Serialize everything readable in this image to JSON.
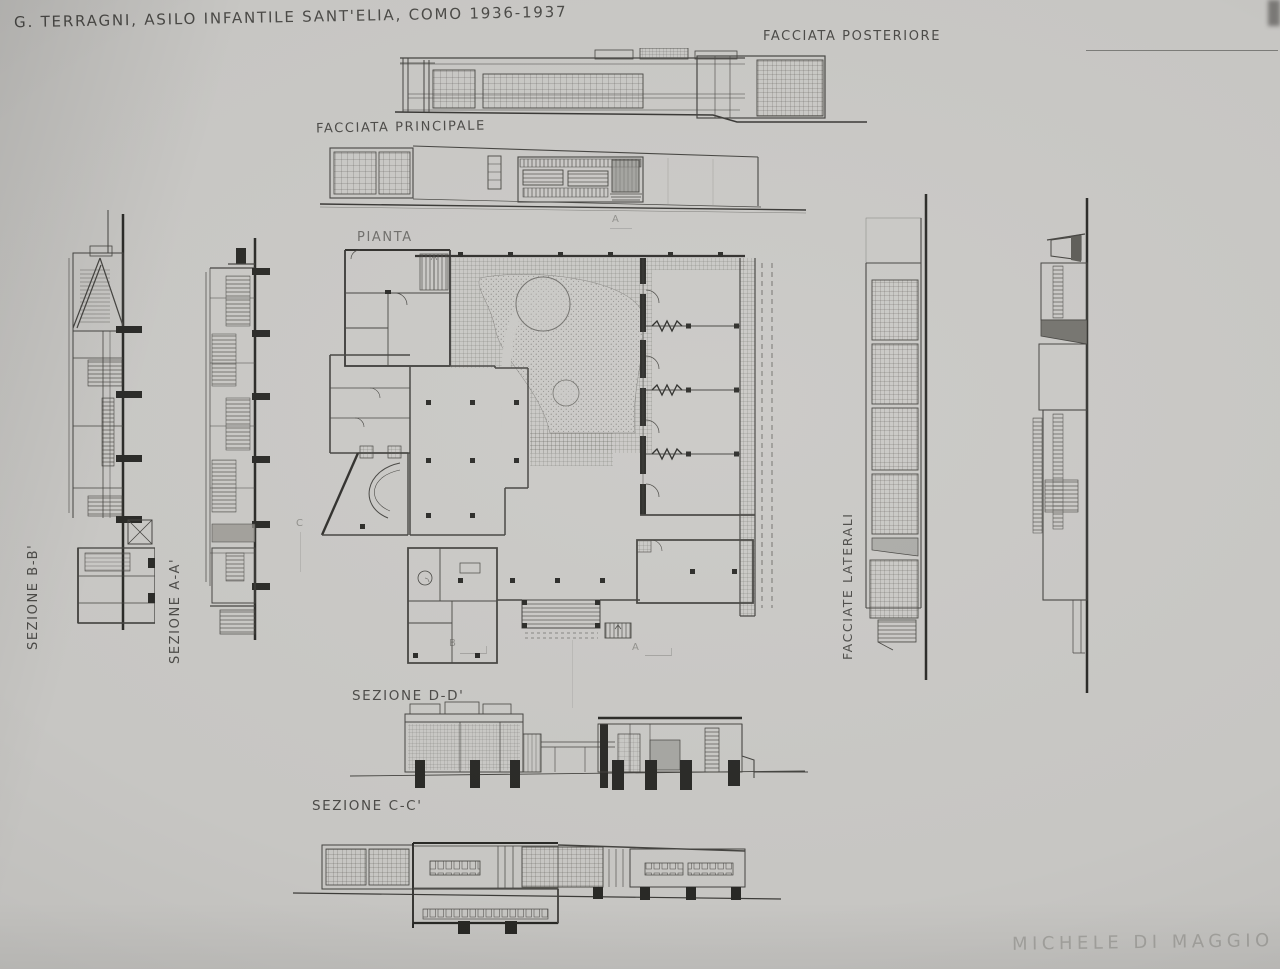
{
  "sheet": {
    "title": "G. TERRAGNI, ASILO INFANTILE SANT'ELIA, COMO 1936-1937",
    "signature": "MICHELE DI MAGGIO",
    "colors": {
      "paper": "#c9c8c5",
      "pencil": "#3b3a36",
      "pencil_heavy": "#201f1d",
      "pencil_faint": "#a7a6a2"
    }
  },
  "labels": {
    "rear_facade": "FACCIATA POSTERIORE",
    "main_facade": "FACCIATA PRINCIPALE",
    "plan": "PIANTA",
    "section_bb": "SEZIONE B-B'",
    "section_aa": "SEZIONE A-A'",
    "side_facades": "FACCIATE LATERALI",
    "section_dd": "SEZIONE D-D'",
    "section_cc": "SEZIONE C-C'"
  },
  "plan_markers": {
    "top_a": "A",
    "bottom_b": "B",
    "bottom_a": "A",
    "left_c": "C"
  }
}
